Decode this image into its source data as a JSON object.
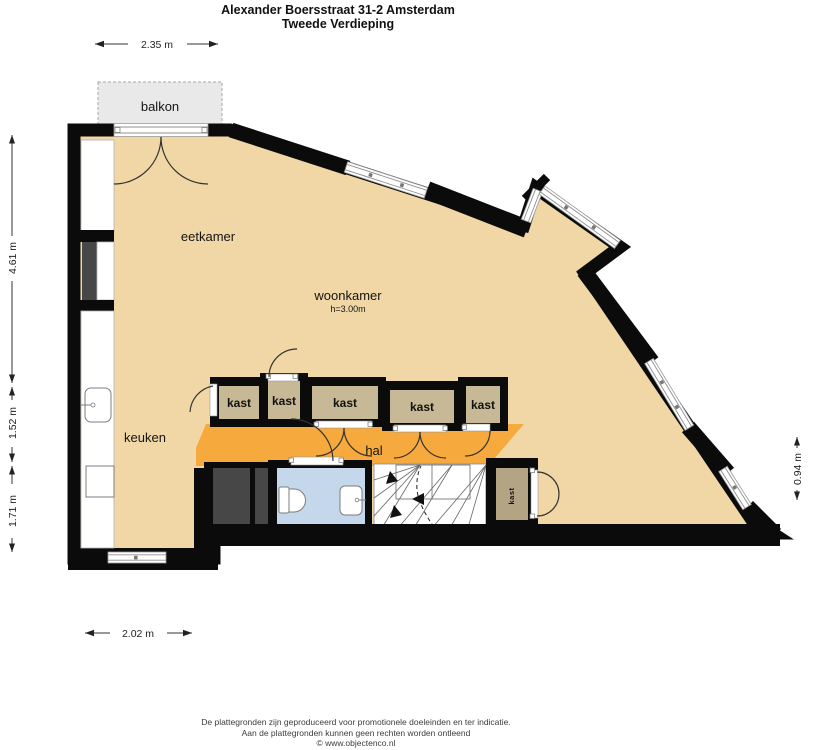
{
  "title": {
    "line1": "Alexander Boersstraat 31-2 Amsterdam",
    "line2": "Tweede Verdieping"
  },
  "rooms": {
    "balkon": "balkon",
    "eetkamer": "eetkamer",
    "woonkamer": "woonkamer",
    "woonkamer_ceiling_height": "h=3.00m",
    "keuken": "keuken",
    "hal": "hal",
    "kast_labels": [
      "kast",
      "kast",
      "kast",
      "kast",
      "kast"
    ],
    "kast_small_vertical": "kast"
  },
  "dimensions": {
    "top": "2.35 m",
    "left_upper": "4.61 m",
    "left_middle": "1.52 m",
    "left_lower": "1.71 m",
    "right_side": "0.94 m",
    "bottom": "2.02 m"
  },
  "footer": {
    "line1": "De plattegronden zijn geproduceerd voor promotionele doeleinden en ter indicatie.",
    "line2": "Aan de plattegronden kunnen geen rechten worden ontleend",
    "line3": "© www.objectenco.nl"
  },
  "colors": {
    "floor": "#f1d7a5",
    "hal": "#f6a93c",
    "kast": "#c8b996",
    "kast_small": "#b3a483",
    "bathroom": "#c5d7ea",
    "balkon": "#e9e9e9",
    "wall": "#0b0b0b",
    "dark_closet": "#474747"
  }
}
